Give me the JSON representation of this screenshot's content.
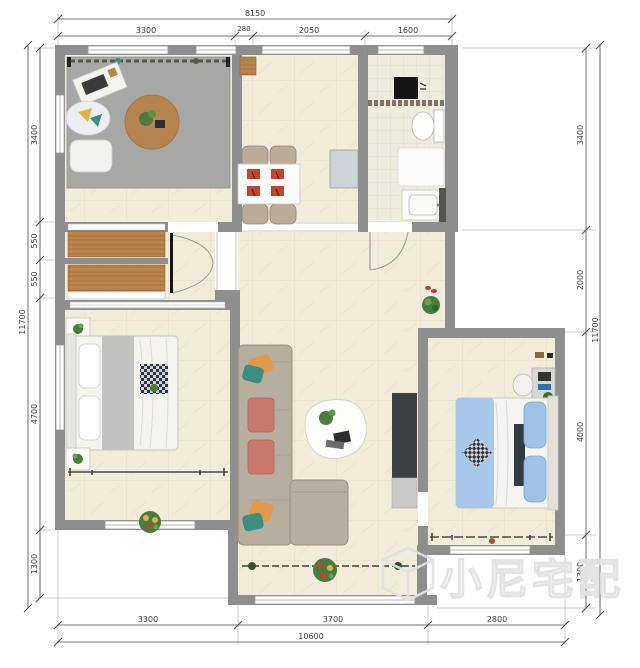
{
  "watermark": {
    "text": "小尼宅配",
    "logo": "isometric-cube"
  },
  "dimensions": {
    "top": {
      "overall": "8150",
      "segments": [
        "3300",
        "280",
        "2050",
        "1600"
      ]
    },
    "bottom": {
      "overall": "10600",
      "segments": [
        "3300",
        "3700",
        "2800"
      ]
    },
    "left": {
      "overall": "11700",
      "segments": [
        "3400",
        "550",
        "550",
        "4700",
        "1300"
      ]
    },
    "right": {
      "overall": "11700",
      "segments": [
        "3400",
        "2000",
        "4000",
        "1300"
      ]
    }
  },
  "palette": {
    "wall": "#8e8e8e",
    "floor_tile": "#f2ecdb",
    "bath_tile": "#efecdf",
    "wood": "#b9854b",
    "rug_gray": "#a7a7a5",
    "round_rug": "#b5854f",
    "sofa": "#b6ae9f",
    "cushion_salmon": "#c77a6b",
    "pillow_orange": "#e09a4a",
    "pillow_teal": "#3e8d82",
    "bed_blue": "#a9c7e8",
    "tv_dark": "#3b4045",
    "dim_text": "#3a3a3a",
    "watermark_gray": "#e2e2e2"
  },
  "furniture_icons": [
    "window-sill-plants",
    "area-rug",
    "round-rug",
    "desk",
    "floor-cushion",
    "pillow",
    "dining-table",
    "dining-chair",
    "placemat",
    "sideboard",
    "duct-column",
    "washing-machine",
    "mosaic-strip",
    "toilet",
    "shower-tray",
    "bathroom-vanity",
    "wardrobe-cabinet",
    "entry-double-door",
    "door-arc",
    "sliding-door",
    "sofa",
    "coffee-table",
    "tv-unit",
    "tv-shelf",
    "bed",
    "nightstand",
    "plant",
    "throw-blanket",
    "curtain-rail",
    "desk-chair",
    "vanity-desk",
    "balcony-flowers",
    "slippers"
  ]
}
